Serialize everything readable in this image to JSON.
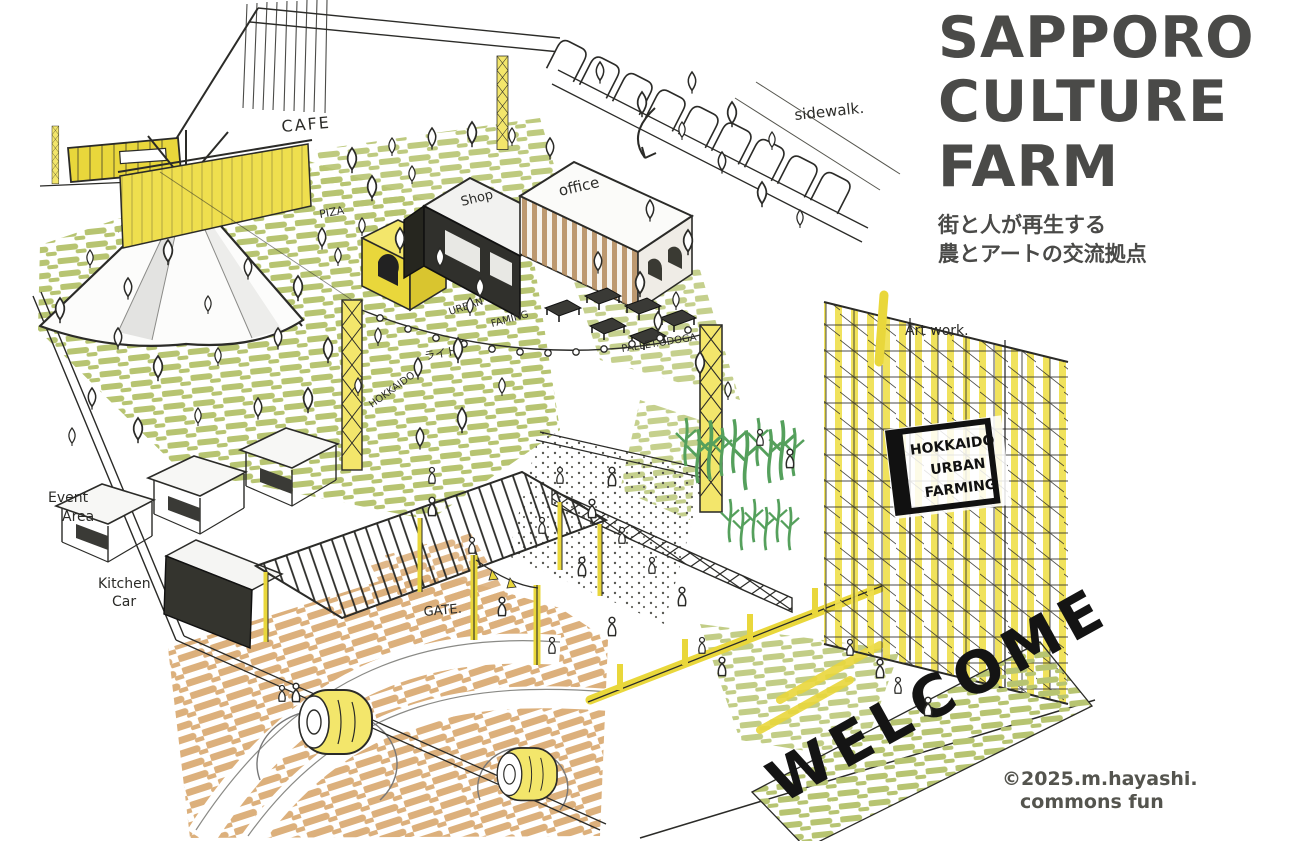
{
  "header": {
    "title_lines": [
      "SAPPORO",
      "CULTURE",
      "FARM"
    ],
    "subtitle_lines": [
      "街と人が再生する",
      "農とアートの交流拠点"
    ]
  },
  "credit": {
    "line1": "©2025.m.hayashi.",
    "line2": "commons fun"
  },
  "labels": {
    "sidewalk": "sidewalk.",
    "cafe": "CAFE",
    "pizza": "PIZA",
    "shop": "Shop",
    "office": "office",
    "urban_farming": {
      "line1": "URBAN",
      "line2": "FAMING"
    },
    "lights_ja": "ライト",
    "hokkaido_path": "HOKKAIDO",
    "pallet_area": "PALLET.ODOGA",
    "art_work": "Art work.",
    "scaffold_sign": {
      "line1": "HOKKAIDO",
      "line2": "URBAN",
      "line3": "FARMING"
    },
    "event_area": {
      "line1": "Event",
      "line2": "Area"
    },
    "kitchen_car": {
      "line1": "Kitchen",
      "line2": "Car"
    },
    "gate": "GATE.",
    "welcome": "WELCOME"
  },
  "colors": {
    "ink": "#2b2b28",
    "title_text": "#4a4a48",
    "highlight_yellow": "#e9d73b",
    "lawn_olive": "#b7c471",
    "dirt_tan": "#dcb07c",
    "plant_green": "#55a05c",
    "wood_brown": "#b3895a"
  }
}
